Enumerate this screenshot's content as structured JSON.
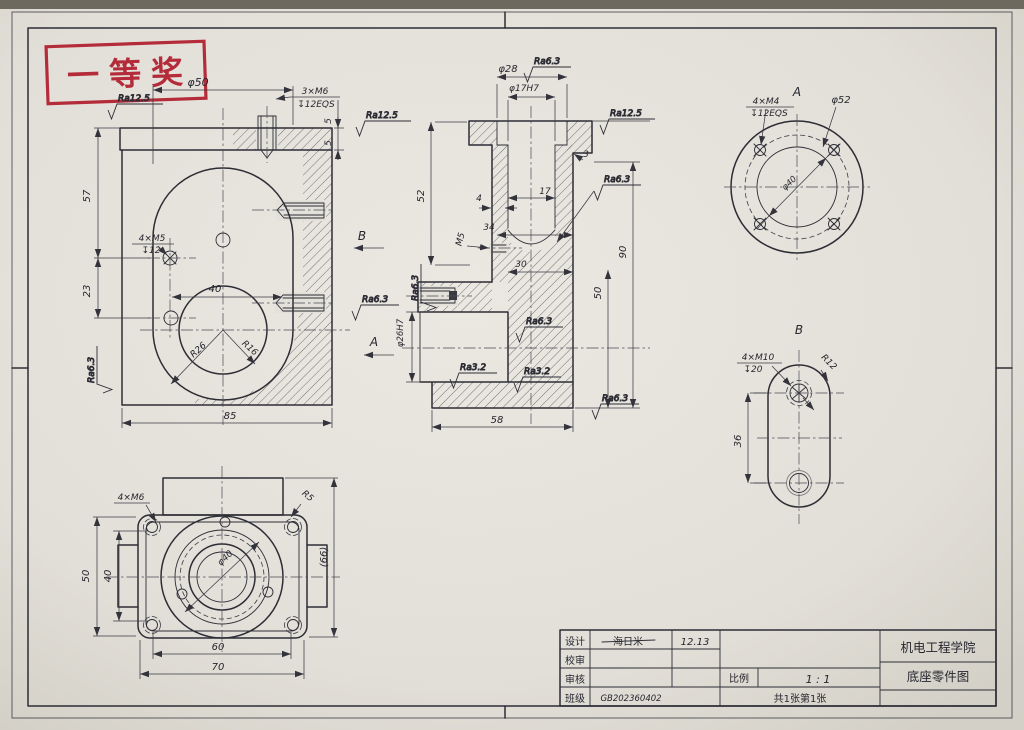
{
  "stamp": {
    "text": "一等奖"
  },
  "front_view": {
    "dia50": "φ50",
    "m6_note": "3×M6",
    "m6_depth": "↧12EQS",
    "ra125_a": "Ra12.5",
    "ra125_b": "Ra12.5",
    "dim5_upper": "5",
    "dim5_lower": "5",
    "dim57": "57",
    "dim23": "23",
    "m5_note": "4×M5",
    "m5_depth": "↧12",
    "dim40": "40",
    "r26": "R26",
    "r16": "R16",
    "dim85": "85",
    "ra63_left": "Ra6.3",
    "ra63_mid": "Ra6.3",
    "section_b": "B",
    "section_a": "A"
  },
  "section_view": {
    "ra63_top": "Ra6.3",
    "dia28": "φ28",
    "dia17h7": "φ17H7",
    "ra125": "Ra12.5",
    "dim3": "3",
    "dim52": "52",
    "dim4": "4",
    "dim17": "17",
    "m5": "M5",
    "dim34": "34",
    "dim30": "30",
    "dim50": "50",
    "dim90": "90",
    "dia26h7": "φ26H7",
    "ra63_dome": "Ra6.3",
    "ra63_side": "Ra6.3",
    "ra63_mid": "Ra6.3",
    "ra32_a": "Ra3.2",
    "ra32_b": "Ra3.2",
    "ra63_bottom": "Ra6.3",
    "dim58": "58"
  },
  "view_a": {
    "label": "A",
    "note": "4×M4",
    "depth": "↧12EQS",
    "dia52": "φ52",
    "dia40": "φ40"
  },
  "view_b": {
    "label": "B",
    "note": "4×M10",
    "depth": "↧20",
    "r12": "R12",
    "dim36": "36"
  },
  "bottom_view": {
    "note": "4×M6",
    "r5": "R5",
    "dim66": "(66)",
    "dim50": "50",
    "dim40": "40",
    "dim60": "60",
    "dim70": "70",
    "dia40": "φ40"
  },
  "title_block": {
    "design_label": "设计",
    "design_name": "海日米",
    "design_date": "12.13",
    "check_label": "校审",
    "audit_label": "审核",
    "class_label": "班级",
    "class_value": "GB202360402",
    "scale_label": "比例",
    "scale_value": "1 : 1",
    "sheet_info": "共1张第1张",
    "org": "机电工程学院",
    "drawing_title": "底座零件图"
  }
}
